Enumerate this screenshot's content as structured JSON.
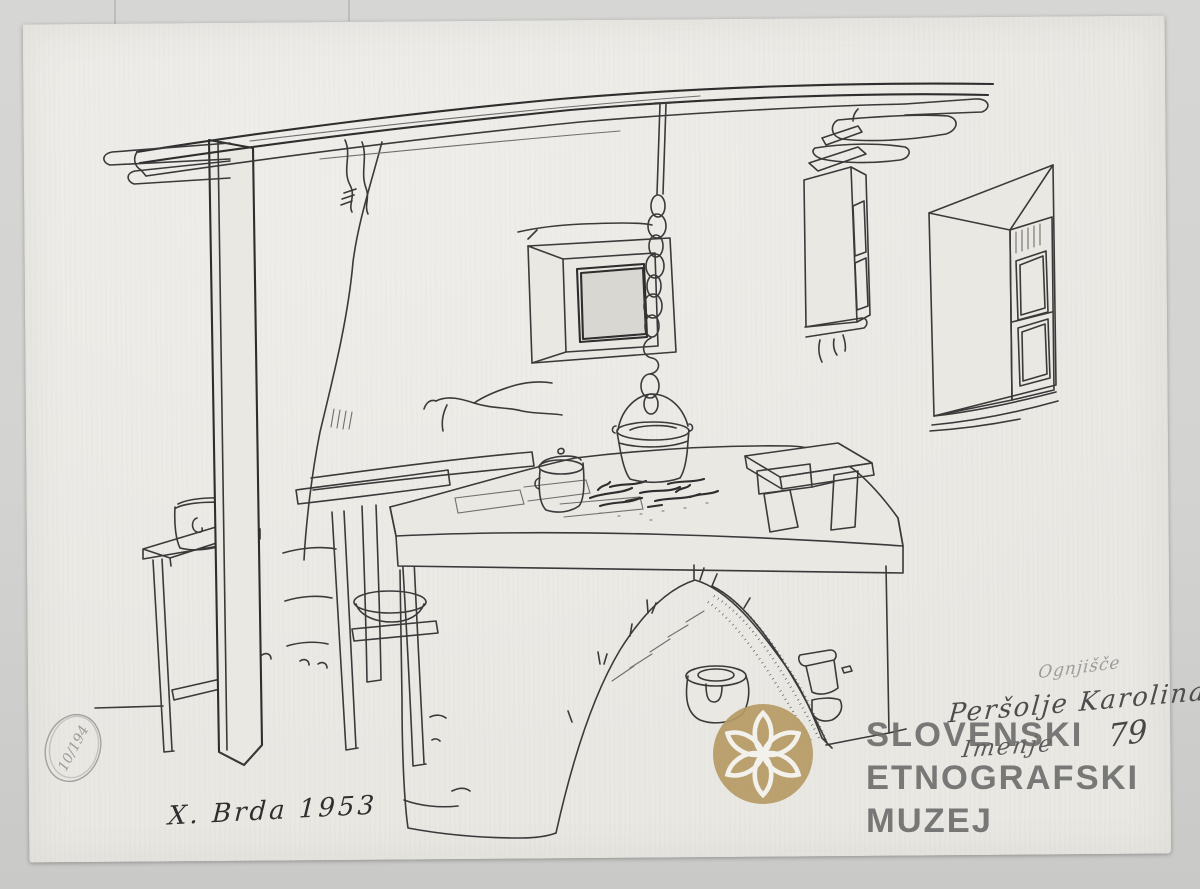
{
  "colors": {
    "background": "#d3d3d1",
    "paper": "#eae8e3",
    "ink": "#3a3a3a",
    "pencil": "#9a9a9a",
    "logo_gold": "#b59a64",
    "watermark_gray": "#6a6a6a"
  },
  "annotations": {
    "signature": "X. Brda 1953",
    "pencil_title": "Ognjišče",
    "name": "Peršolje Karolina",
    "place": "Imenje",
    "house_number": "79",
    "stamp_number": "10/194"
  },
  "watermark": {
    "line1": "SLOVENSKI",
    "line2": "ETNOGRAFSKI",
    "line3": "MUZEJ",
    "logo_color": "#b59a64",
    "text_color": "#6a6a6a"
  }
}
